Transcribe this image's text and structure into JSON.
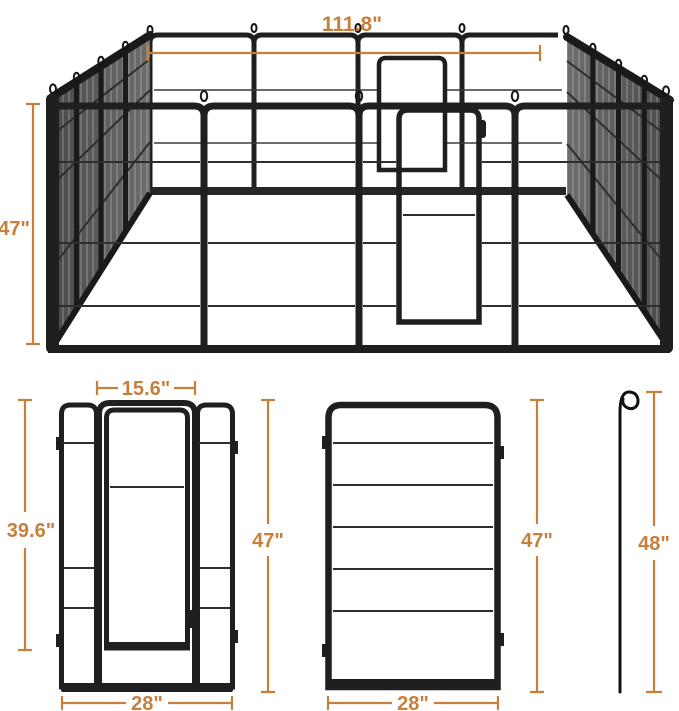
{
  "colors": {
    "dimension_accent": "#C6803C",
    "frame": "#1F1F1F",
    "background": "#FFFFFF"
  },
  "figures": {
    "playpen_3d": {
      "overall_width": "111.8\"",
      "panel_height": "47\""
    },
    "door_panel": {
      "door_width": "15.6\"",
      "door_height": "39.6\"",
      "panel_width": "28\""
    },
    "plain_panel": {
      "height_left": "47\"",
      "height_right": "47\"",
      "width": "28\""
    },
    "ground_stake": {
      "height": "48\""
    }
  }
}
